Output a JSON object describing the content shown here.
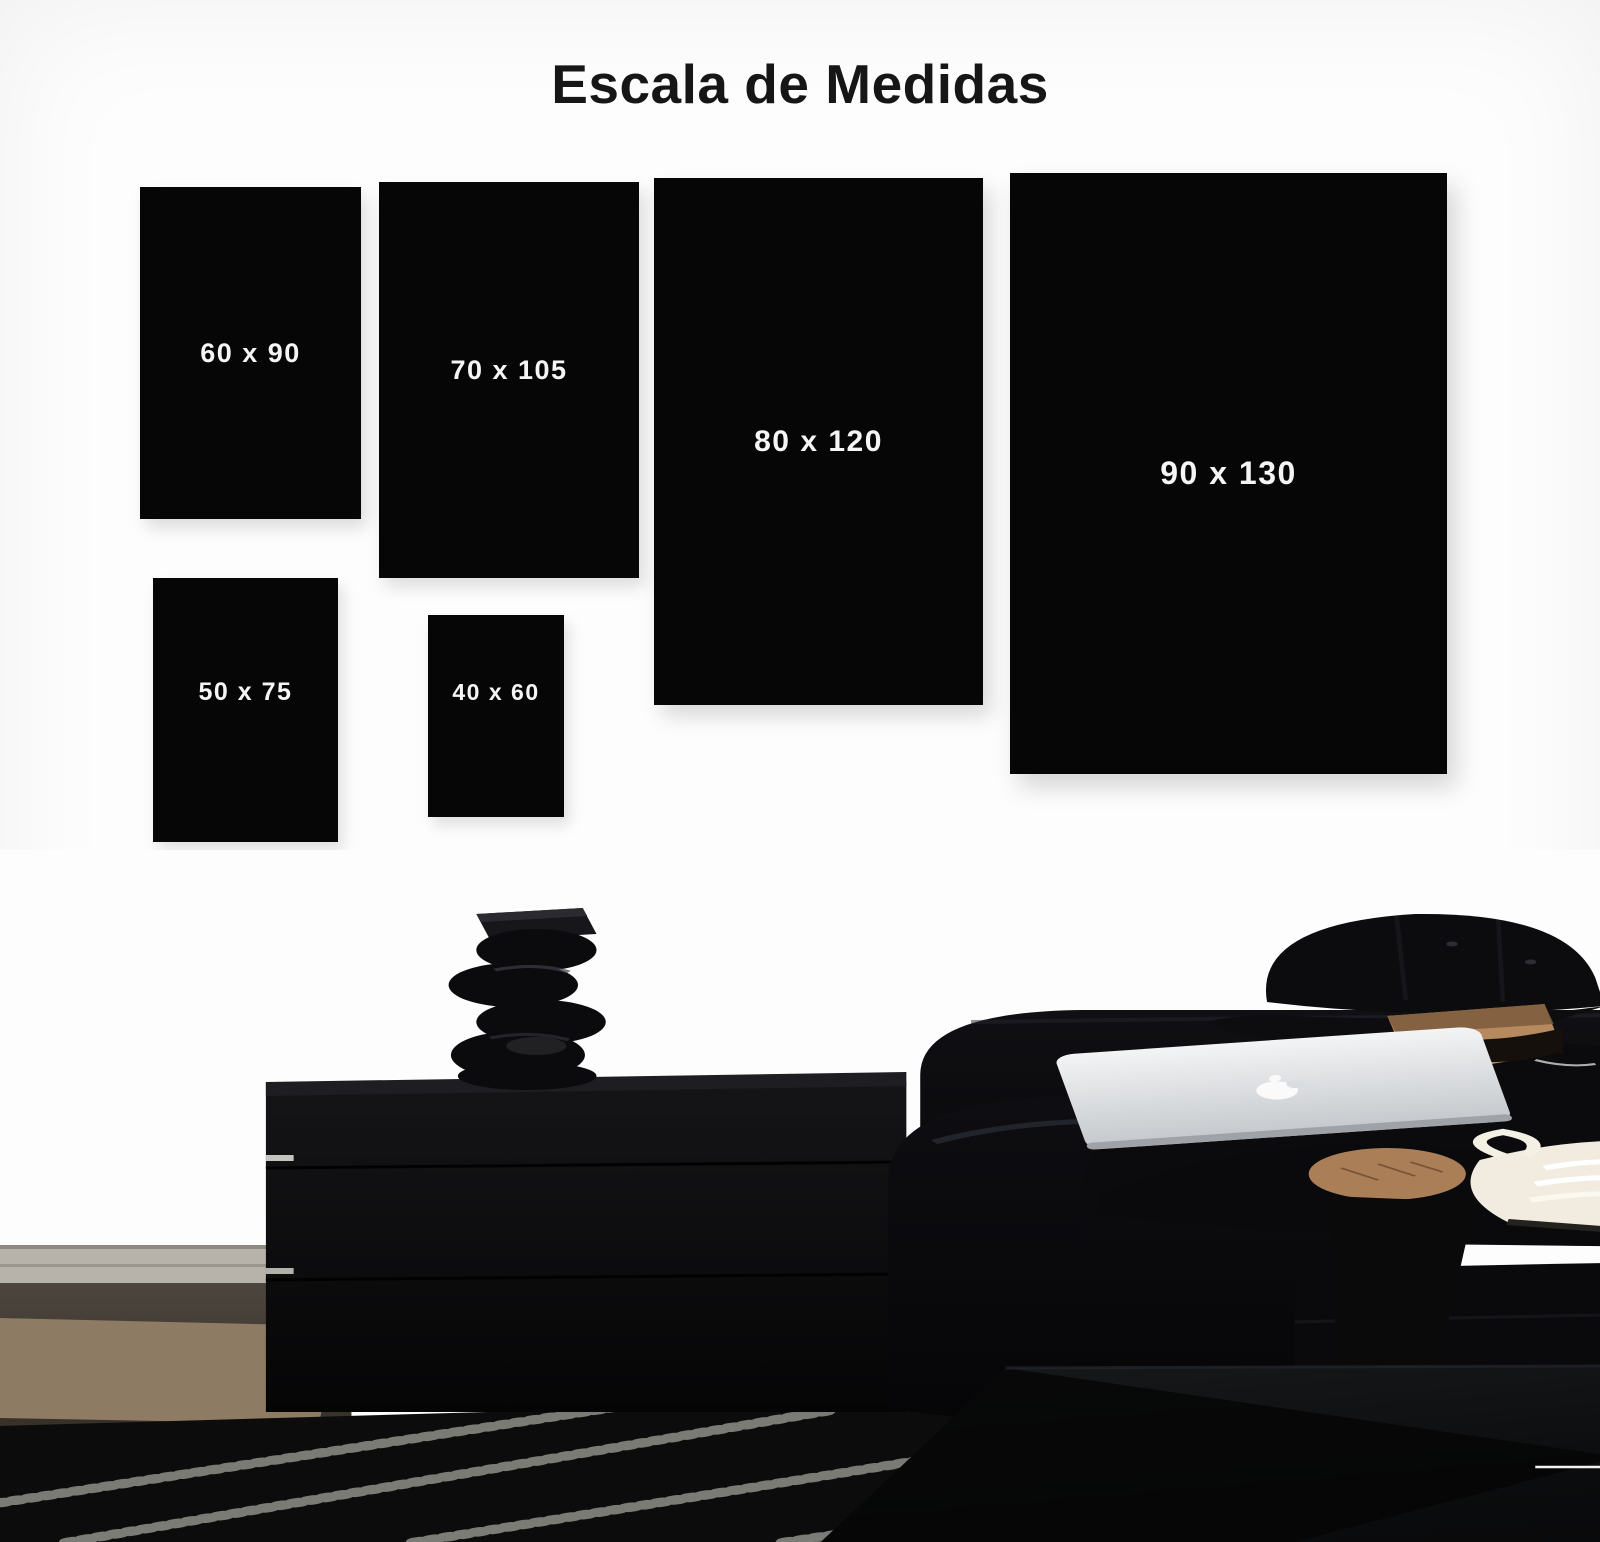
{
  "title": "Escala de Medidas",
  "sizes": [
    {
      "label": "60 x 90",
      "width_cm": 60,
      "height_cm": 90
    },
    {
      "label": "70 x 105",
      "width_cm": 70,
      "height_cm": 105
    },
    {
      "label": "80 x 120",
      "width_cm": 80,
      "height_cm": 120
    },
    {
      "label": "90 x 130",
      "width_cm": 90,
      "height_cm": 130
    },
    {
      "label": "50 x 75",
      "width_cm": 50,
      "height_cm": 75
    },
    {
      "label": "40 x 60",
      "width_cm": 40,
      "height_cm": 60
    }
  ],
  "brand": {
    "design_label": "DESIGN",
    "monogram_icon": "rm-monogram"
  },
  "colors": {
    "background": "#fdfdfd",
    "title": "#161616",
    "poster": "#060606",
    "poster_label": "#f5f5f5",
    "couch": "#0a0a0d",
    "jeans": "#a7bece",
    "rug_black": "#0c0c0c",
    "rug_white": "#d8d7d2",
    "logo": "#f2f2f1"
  }
}
